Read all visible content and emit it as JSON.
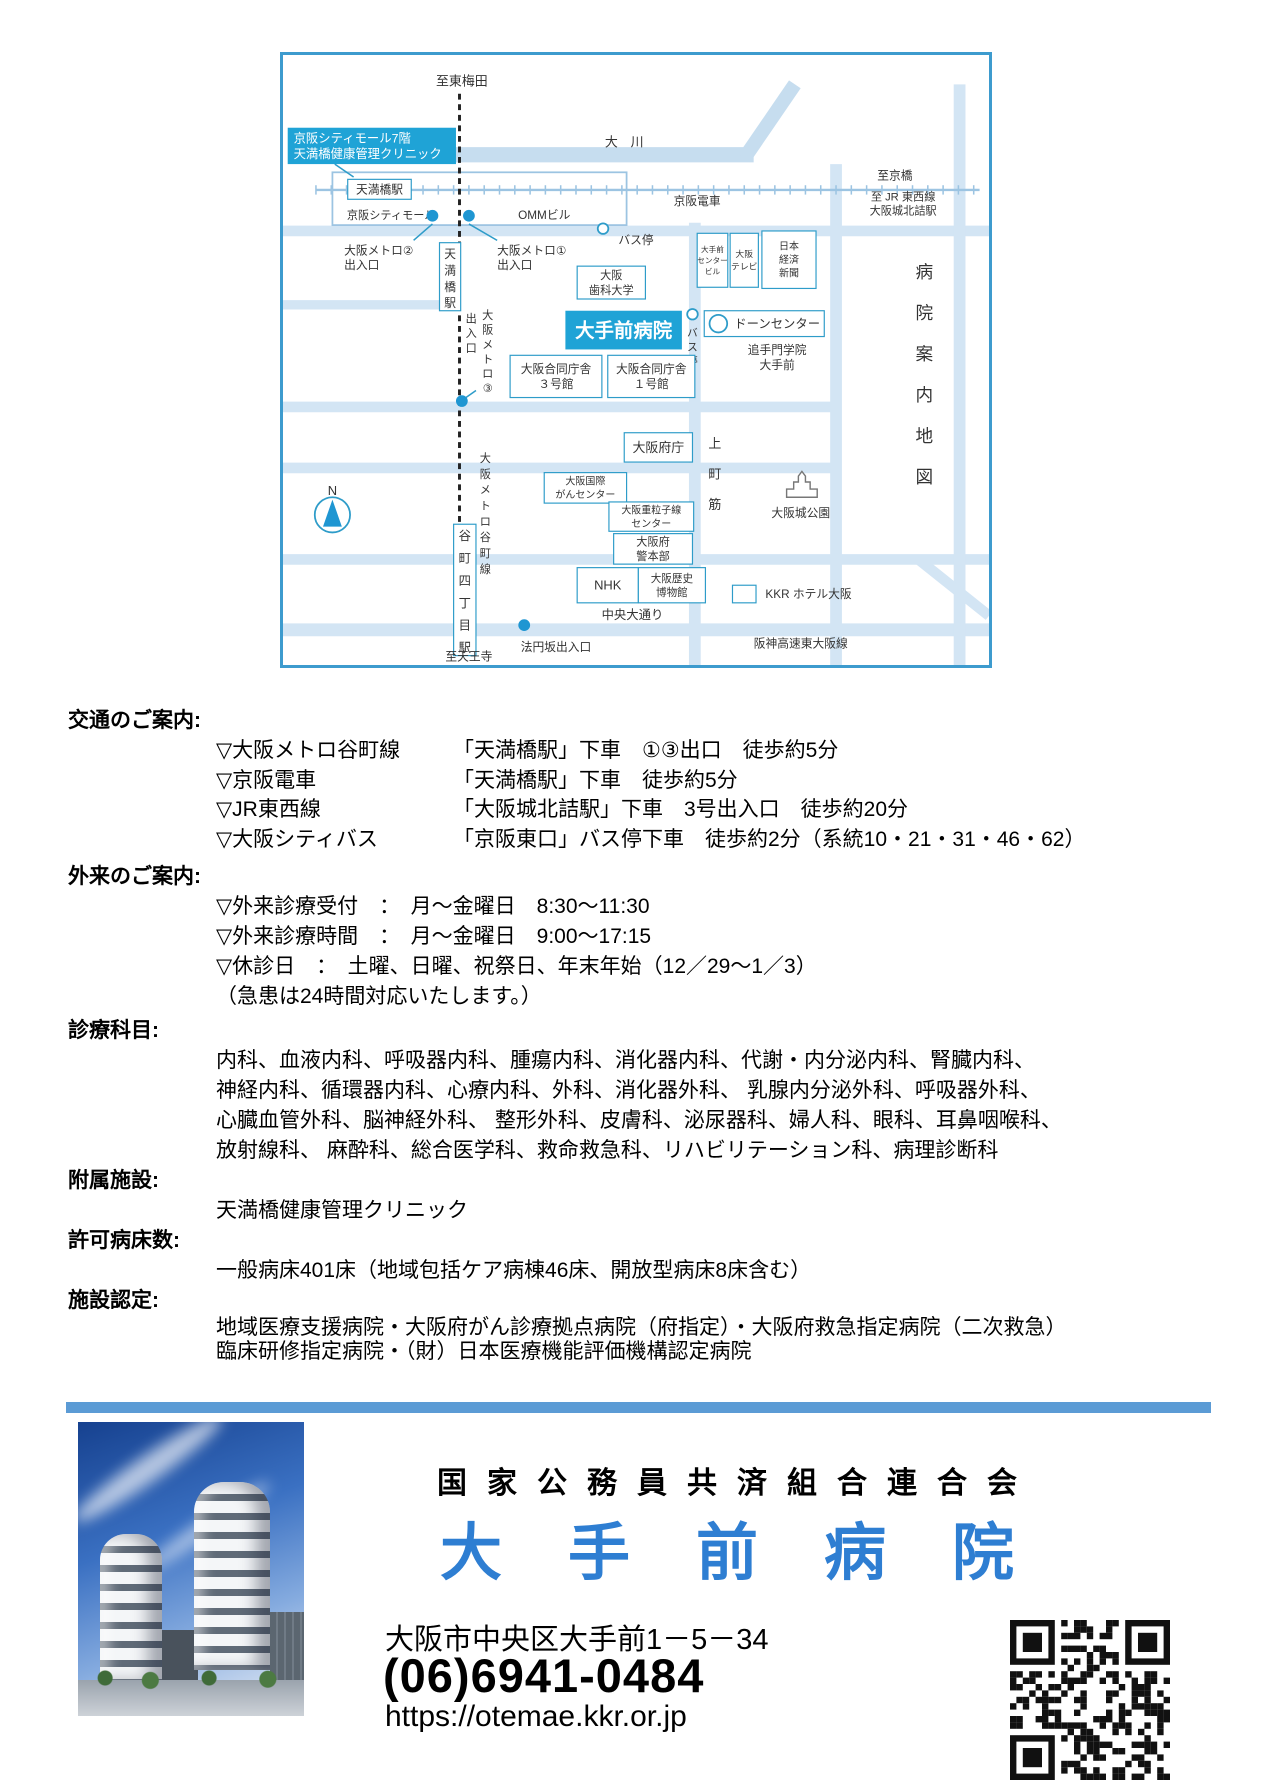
{
  "map": {
    "colors": {
      "road": "#d3e5f4",
      "river": "#c6ddef",
      "rail": "#9cc4e2",
      "border": "#3d9bce",
      "box": "#2e9cc9",
      "hl": "#1fa3d6",
      "dot": "#1f96d2",
      "text": "#333333"
    },
    "roads": [
      [
        30,
        85,
        400,
        85,
        13,
        "river"
      ],
      [
        392,
        88,
        435,
        25,
        12,
        "river"
      ],
      [
        0,
        150,
        600,
        150,
        9
      ],
      [
        0,
        213,
        138,
        213,
        8
      ],
      [
        0,
        300,
        470,
        300,
        9
      ],
      [
        0,
        352,
        470,
        352,
        9
      ],
      [
        0,
        430,
        600,
        430,
        9
      ],
      [
        0,
        490,
        600,
        490,
        11
      ],
      [
        350,
        143,
        350,
        520,
        10
      ],
      [
        470,
        93,
        470,
        520,
        10
      ],
      [
        575,
        25,
        575,
        520,
        10
      ],
      [
        540,
        430,
        600,
        478,
        9
      ]
    ],
    "railway": {
      "x1": 28,
      "y": 115,
      "x2": 592
    },
    "station_rect": [
      42,
      100,
      250,
      45
    ],
    "metro": {
      "x": 150,
      "y1": 33,
      "y2": 505
    },
    "leaders": [
      [
        127,
        144,
        111,
        158
      ],
      [
        158,
        144,
        182,
        158
      ],
      [
        44,
        93,
        60,
        104
      ],
      [
        164,
        286,
        154,
        293
      ]
    ],
    "dots": [
      [
        127,
        137
      ],
      [
        158,
        137
      ],
      [
        152,
        295
      ],
      [
        205,
        486
      ]
    ],
    "stops": [
      [
        272,
        148,
        4.5
      ],
      [
        348,
        221,
        4.5
      ],
      [
        370,
        229,
        7.5
      ]
    ],
    "compass": [
      42,
      392
    ],
    "castle": [
      428,
      355
    ],
    "labels": [
      {
        "t": "至東梅田",
        "x": 152,
        "y": 26,
        "fs": 11
      },
      {
        "t": "大　川",
        "x": 290,
        "y": 78,
        "fs": 11
      },
      {
        "t": "天満橋駅",
        "x": 55,
        "y": 106,
        "w": 54,
        "h": 17,
        "fs": 10,
        "ty": "box"
      },
      {
        "t": "京阪シティモール",
        "x": 92,
        "y": 140,
        "fs": 9.5
      },
      {
        "t": "OMMビル",
        "x": 222,
        "y": 140,
        "fs": 10
      },
      {
        "t": "京阪電車",
        "x": 352,
        "y": 128,
        "fs": 10
      },
      {
        "t": "至京橋",
        "x": 520,
        "y": 106,
        "fs": 10
      },
      {
        "t": "至 JR 東西線\n大阪城北詰駅",
        "x": 527,
        "y": 124,
        "fs": 9.5
      },
      {
        "t": "バス停",
        "x": 300,
        "y": 161,
        "fs": 10
      },
      {
        "t": "大阪メトロ②\n出入口",
        "x": 52,
        "y": 170,
        "fs": 10,
        "an": "s"
      },
      {
        "t": "大阪メトロ①\n出入口",
        "x": 182,
        "y": 170,
        "fs": 10,
        "an": "s"
      },
      {
        "t": "京阪シティモール7階\n天満橋健康管理クリニック",
        "x": 4,
        "y": 62,
        "w": 143,
        "h": 31,
        "fs": 10.5,
        "ty": "hl",
        "an": "s"
      },
      {
        "t": "天満橋駅",
        "x": 133,
        "y": 160,
        "w": 18,
        "h": 58,
        "fs": 10,
        "ty": "vbox"
      },
      {
        "t": "大手前\nセンター\nビル",
        "x": 352,
        "y": 152,
        "w": 26,
        "h": 46,
        "fs": 6.5,
        "ty": "box"
      },
      {
        "t": "大阪\nテレビ",
        "x": 380,
        "y": 152,
        "w": 24,
        "h": 46,
        "fs": 7.5,
        "ty": "box"
      },
      {
        "t": "日本\n経済\n新聞",
        "x": 407,
        "y": 150,
        "w": 46,
        "h": 49,
        "fs": 8.5,
        "ty": "box"
      },
      {
        "t": "大阪\n歯科大学",
        "x": 250,
        "y": 180,
        "w": 58,
        "h": 28,
        "fs": 9.5,
        "ty": "box"
      },
      {
        "t": "大手前病院",
        "x": 240,
        "y": 218,
        "w": 99,
        "h": 33,
        "fs": 16.5,
        "ty": "hl",
        "b": 1
      },
      {
        "t": "バス停",
        "x": 348,
        "y": 240,
        "sp": 12,
        "fs": 9,
        "ty": "v"
      },
      {
        "t": "ドーンセンター",
        "x": 358,
        "y": 218,
        "w": 102,
        "h": 22,
        "fs": 10.5,
        "ty": "box",
        "tx": 420
      },
      {
        "t": "追手門学院\n大手前",
        "x": 420,
        "y": 255,
        "fs": 10
      },
      {
        "t": "出入口",
        "x": 160,
        "y": 228,
        "sp": 12.5,
        "fs": 9.5,
        "ty": "v"
      },
      {
        "t": "大阪メトロ③",
        "x": 174,
        "y": 225,
        "sp": 12.5,
        "fs": 9.5,
        "ty": "v"
      },
      {
        "t": "大阪合同庁舎\n３号館",
        "x": 193,
        "y": 256,
        "w": 78,
        "h": 36,
        "fs": 10,
        "ty": "box"
      },
      {
        "t": "大阪合同庁舎\n１号館",
        "x": 276,
        "y": 256,
        "w": 74,
        "h": 36,
        "fs": 10,
        "ty": "box"
      },
      {
        "t": "大阪府庁",
        "x": 290,
        "y": 322,
        "w": 58,
        "h": 25,
        "fs": 11,
        "ty": "box"
      },
      {
        "t": "上",
        "x": 367,
        "y": 335,
        "fs": 11
      },
      {
        "t": "町",
        "x": 367,
        "y": 361,
        "fs": 11
      },
      {
        "t": "筋",
        "x": 367,
        "y": 387,
        "fs": 11
      },
      {
        "t": "大阪国際\nがんセンター",
        "x": 222,
        "y": 356,
        "w": 70,
        "h": 26,
        "fs": 8.5,
        "ty": "box"
      },
      {
        "t": "大阪重粒子線\nセンター",
        "x": 277,
        "y": 381,
        "w": 72,
        "h": 25,
        "fs": 8.5,
        "ty": "box"
      },
      {
        "t": "大阪府\n警本部",
        "x": 281,
        "y": 408,
        "w": 67,
        "h": 26,
        "fs": 9.5,
        "ty": "box"
      },
      {
        "t": "N",
        "x": 42,
        "y": 375,
        "fs": 11
      },
      {
        "t": "大阪メトロ谷町線",
        "x": 172,
        "y": 347,
        "sp": 13.5,
        "fs": 9.5,
        "ty": "v"
      },
      {
        "t": "谷町四丁目駅",
        "x": 145,
        "y": 400,
        "w": 19,
        "h": 112,
        "fs": 10.5,
        "ty": "vbox"
      },
      {
        "t": "NHK",
        "x": 250,
        "y": 437,
        "w": 52,
        "h": 30,
        "fs": 11,
        "ty": "box"
      },
      {
        "t": "大阪歴史\n博物館",
        "x": 302,
        "y": 437,
        "w": 57,
        "h": 30,
        "fs": 9,
        "ty": "box"
      },
      {
        "t": "",
        "x": 382,
        "y": 452,
        "w": 20,
        "h": 15,
        "ty": "box"
      },
      {
        "t": "KKR ホテル大阪",
        "x": 410,
        "y": 463,
        "fs": 10,
        "an": "s"
      },
      {
        "t": "大阪城公園",
        "x": 440,
        "y": 394,
        "fs": 10
      },
      {
        "t": "中央大通り",
        "x": 297,
        "y": 481,
        "fs": 10.5
      },
      {
        "t": "法円坂出入口",
        "x": 232,
        "y": 508,
        "fs": 10
      },
      {
        "t": "阪神高速東大阪線",
        "x": 440,
        "y": 505,
        "fs": 10
      },
      {
        "t": "至天王寺",
        "x": 158,
        "y": 516,
        "fs": 10
      },
      {
        "t": "病院案内地図",
        "x": 545,
        "y": 190,
        "sp": 35,
        "fs": 15,
        "ty": "v"
      }
    ]
  },
  "sections": {
    "access": {
      "heading": "交通のご案内:",
      "items": [
        {
          "mode": "▽大阪メトロ谷町線",
          "detail": "「天満橋駅」下車　①③出口　徒歩約5分"
        },
        {
          "mode": "▽京阪電車",
          "detail": "「天満橋駅」下車　徒歩約5分"
        },
        {
          "mode": "▽JR東西線",
          "detail": "「大阪城北詰駅」下車　3号出入口　徒歩約20分"
        },
        {
          "mode": "▽大阪シティバス",
          "detail": "「京阪東口」バス停下車　徒歩約2分（系統10・21・31・46・62）"
        }
      ]
    },
    "outpatient": {
      "heading": "外来のご案内:",
      "items": [
        "▽外来診療受付　：　月～金曜日　8:30～11:30",
        "▽外来診療時間　：　月～金曜日　9:00～17:15",
        "▽休診日　：　土曜、日曜、祝祭日、年末年始（12／29～1／3）",
        "（急患は24時間対応いたします。）"
      ]
    },
    "departments": {
      "heading": "診療科目:",
      "lines": [
        "内科、血液内科、呼吸器内科、腫瘍内科、消化器内科、代謝・内分泌内科、腎臓内科、",
        "神経内科、循環器内科、心療内科、外科、消化器外科、 乳腺内分泌外科、呼吸器外科、",
        "心臓血管外科、脳神経外科、 整形外科、皮膚科、泌尿器科、婦人科、眼科、耳鼻咽喉科、",
        "放射線科、 麻酔科、総合医学科、救命救急科、リハビリテーション科、病理診断科"
      ]
    },
    "facility": {
      "heading": "附属施設:",
      "value": "天満橋健康管理クリニック"
    },
    "beds": {
      "heading": "許可病床数:",
      "value": "一般病床401床（地域包括ケア病棟46床、開放型病床8床含む）"
    },
    "certification": {
      "heading": "施設認定:",
      "lines": [
        "地域医療支援病院・大阪府がん診療拠点病院（府指定）・大阪府救急指定病院（二次救急）",
        "臨床研修指定病院・（財）日本医療機能評価機構認定病院"
      ]
    }
  },
  "footer": {
    "organization": "国家公務員共済組合連合会",
    "hospital_name": "大手前病院",
    "address": "大阪市中央区大手前1－5－34",
    "phone": "(06)6941-0484",
    "url": "https://otemae.kkr.or.jp",
    "accent_color": "#5b9bd5",
    "name_color": "#2e7ed2"
  }
}
